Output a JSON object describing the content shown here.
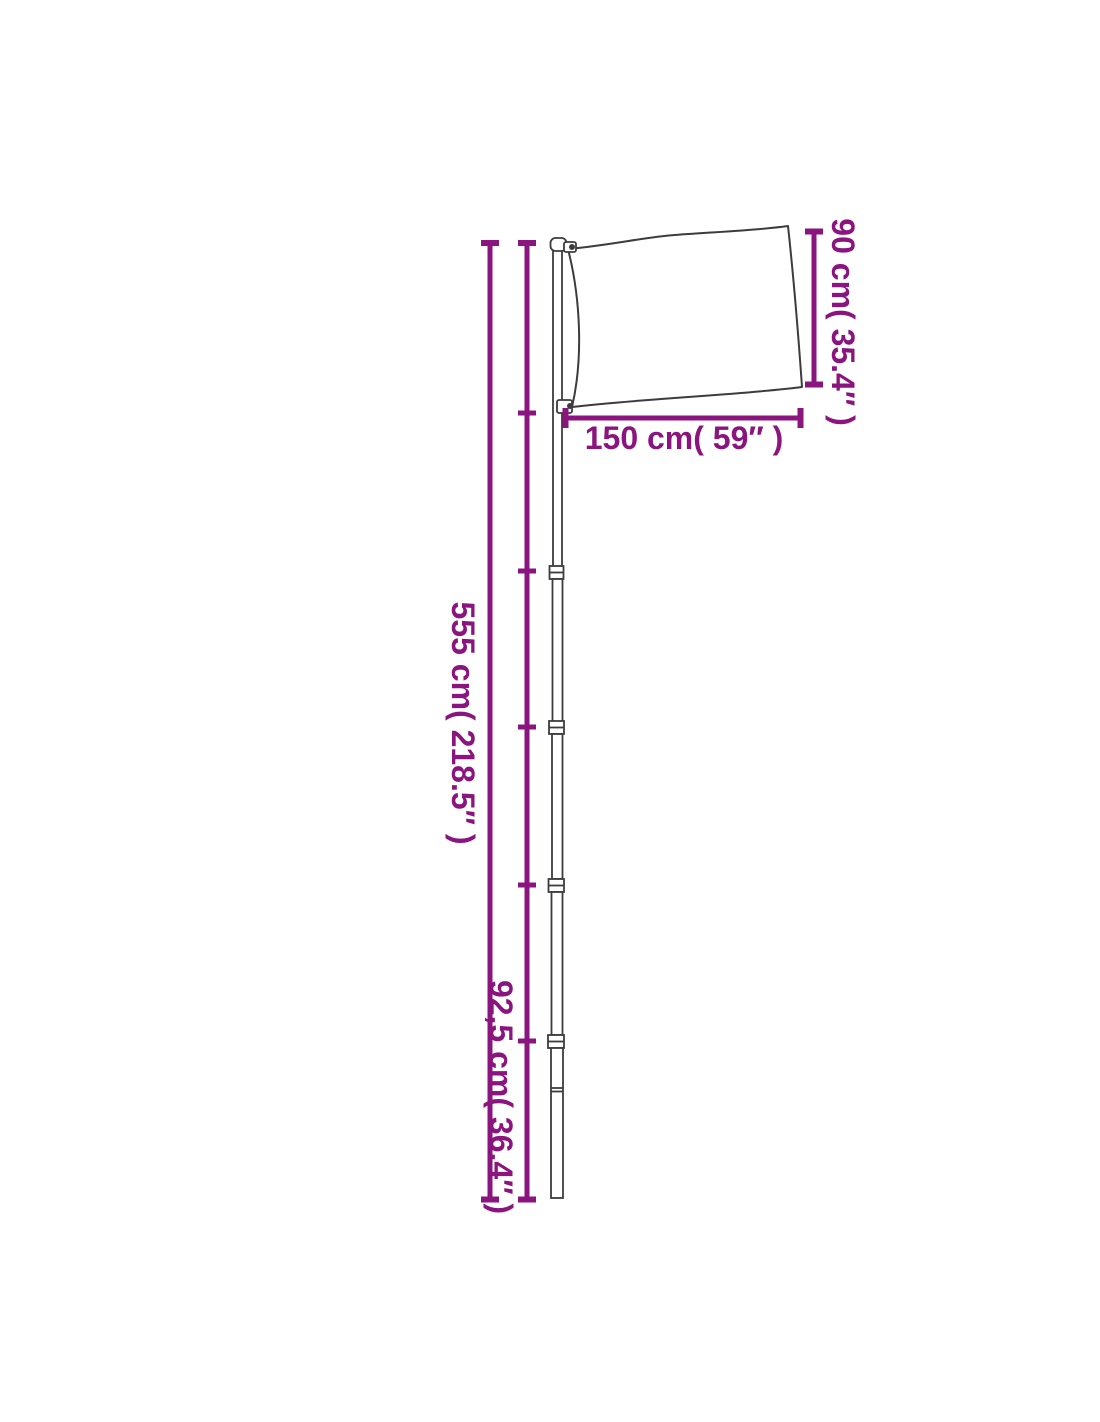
{
  "colors": {
    "dimension": "#8a157f",
    "outline": "#3c3c3c",
    "background": "#ffffff"
  },
  "diagram": {
    "labels": {
      "flag_height": "90 cm( 35.4″ )",
      "flag_width": "150 cm( 59″ )",
      "pole_height": "555 cm( 218.5″ )",
      "section_height": "92,5 cm( 36.4″ )"
    }
  }
}
